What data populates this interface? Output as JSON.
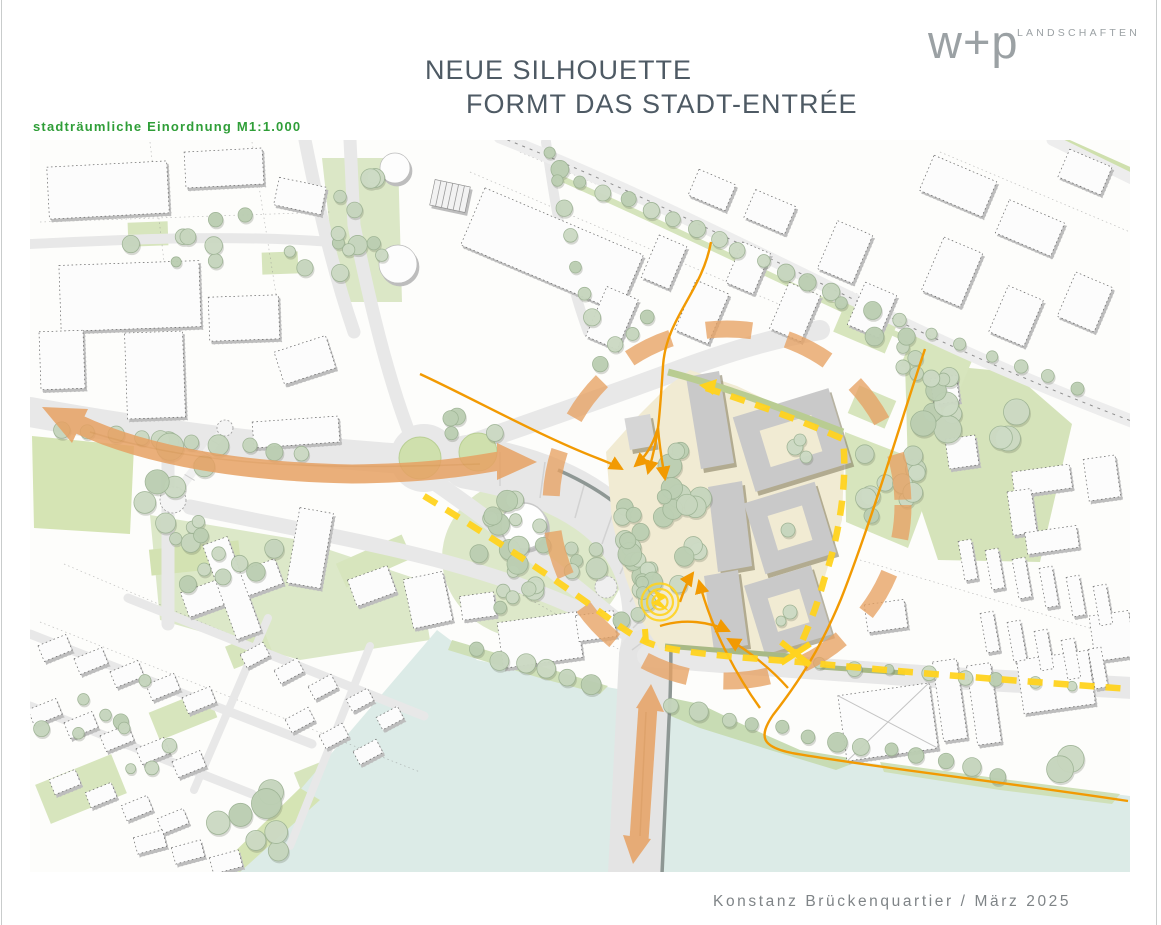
{
  "header": {
    "title_line1": "NEUE SILHOUETTE",
    "title_line2": "FORMT DAS STADT-ENTRÉE"
  },
  "logo": {
    "mark": "w+p",
    "wordmark": "LANDSCHAFTEN"
  },
  "map": {
    "label": "stadträumliche Einordnung M1:1.000",
    "scale": "M1:1.000"
  },
  "footer": {
    "caption": "Konstanz Brückenquartier / März 2025"
  },
  "colors": {
    "title_text": "#4E5A64",
    "logo_gray": "#9BA1A4",
    "label_green": "#2F9E38",
    "caption_gray": "#7F8487",
    "arrow_orange": "#E7A163",
    "flow_orange": "#F29A02",
    "route_yellow": "#FFD31F",
    "water": "#DCEBE7",
    "greenery": "#D7E5BD",
    "tree_green": "#C4D4BB",
    "road_gray": "#E8E8E8",
    "site_ground": "#F1EBD3",
    "site_building": "#C9C9C9",
    "building_white": "#FCFCFC"
  }
}
